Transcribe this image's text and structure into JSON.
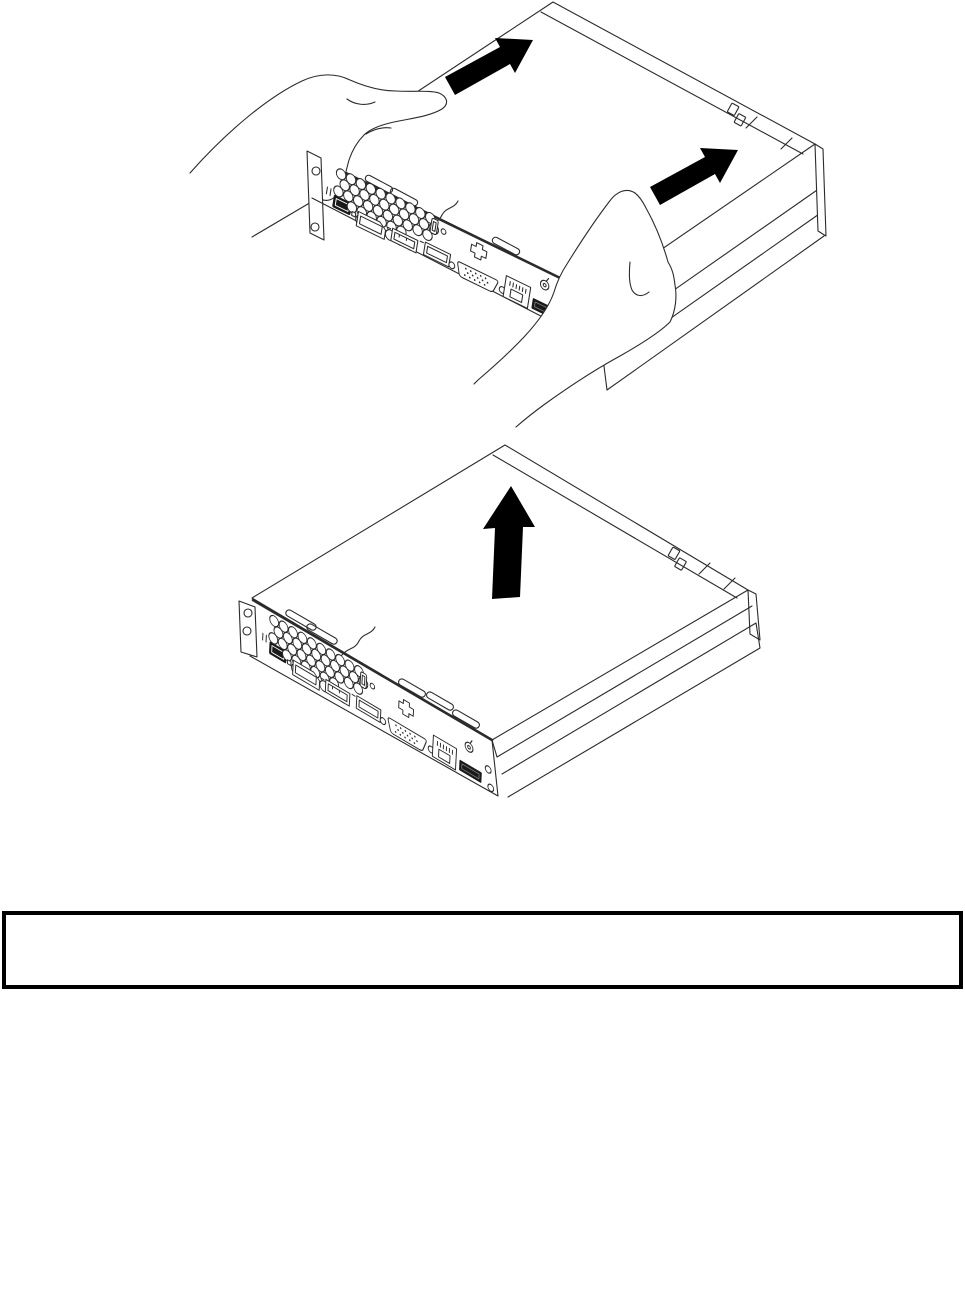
{
  "page": {
    "background_color": "#ffffff"
  },
  "figures": {
    "slide_cover": {
      "label": "hands-sliding-computer-cover-toward-rear",
      "arrow_count": 2,
      "arrow_color": "#000000",
      "line_color": "#2b2b2b"
    },
    "lift_cover": {
      "label": "computer-cover-lifted-off-chassis",
      "arrow_count": 1,
      "arrow_color": "#000000",
      "line_color": "#2b2b2b"
    }
  },
  "note_box": {
    "content": "",
    "border_color": "#000000"
  }
}
